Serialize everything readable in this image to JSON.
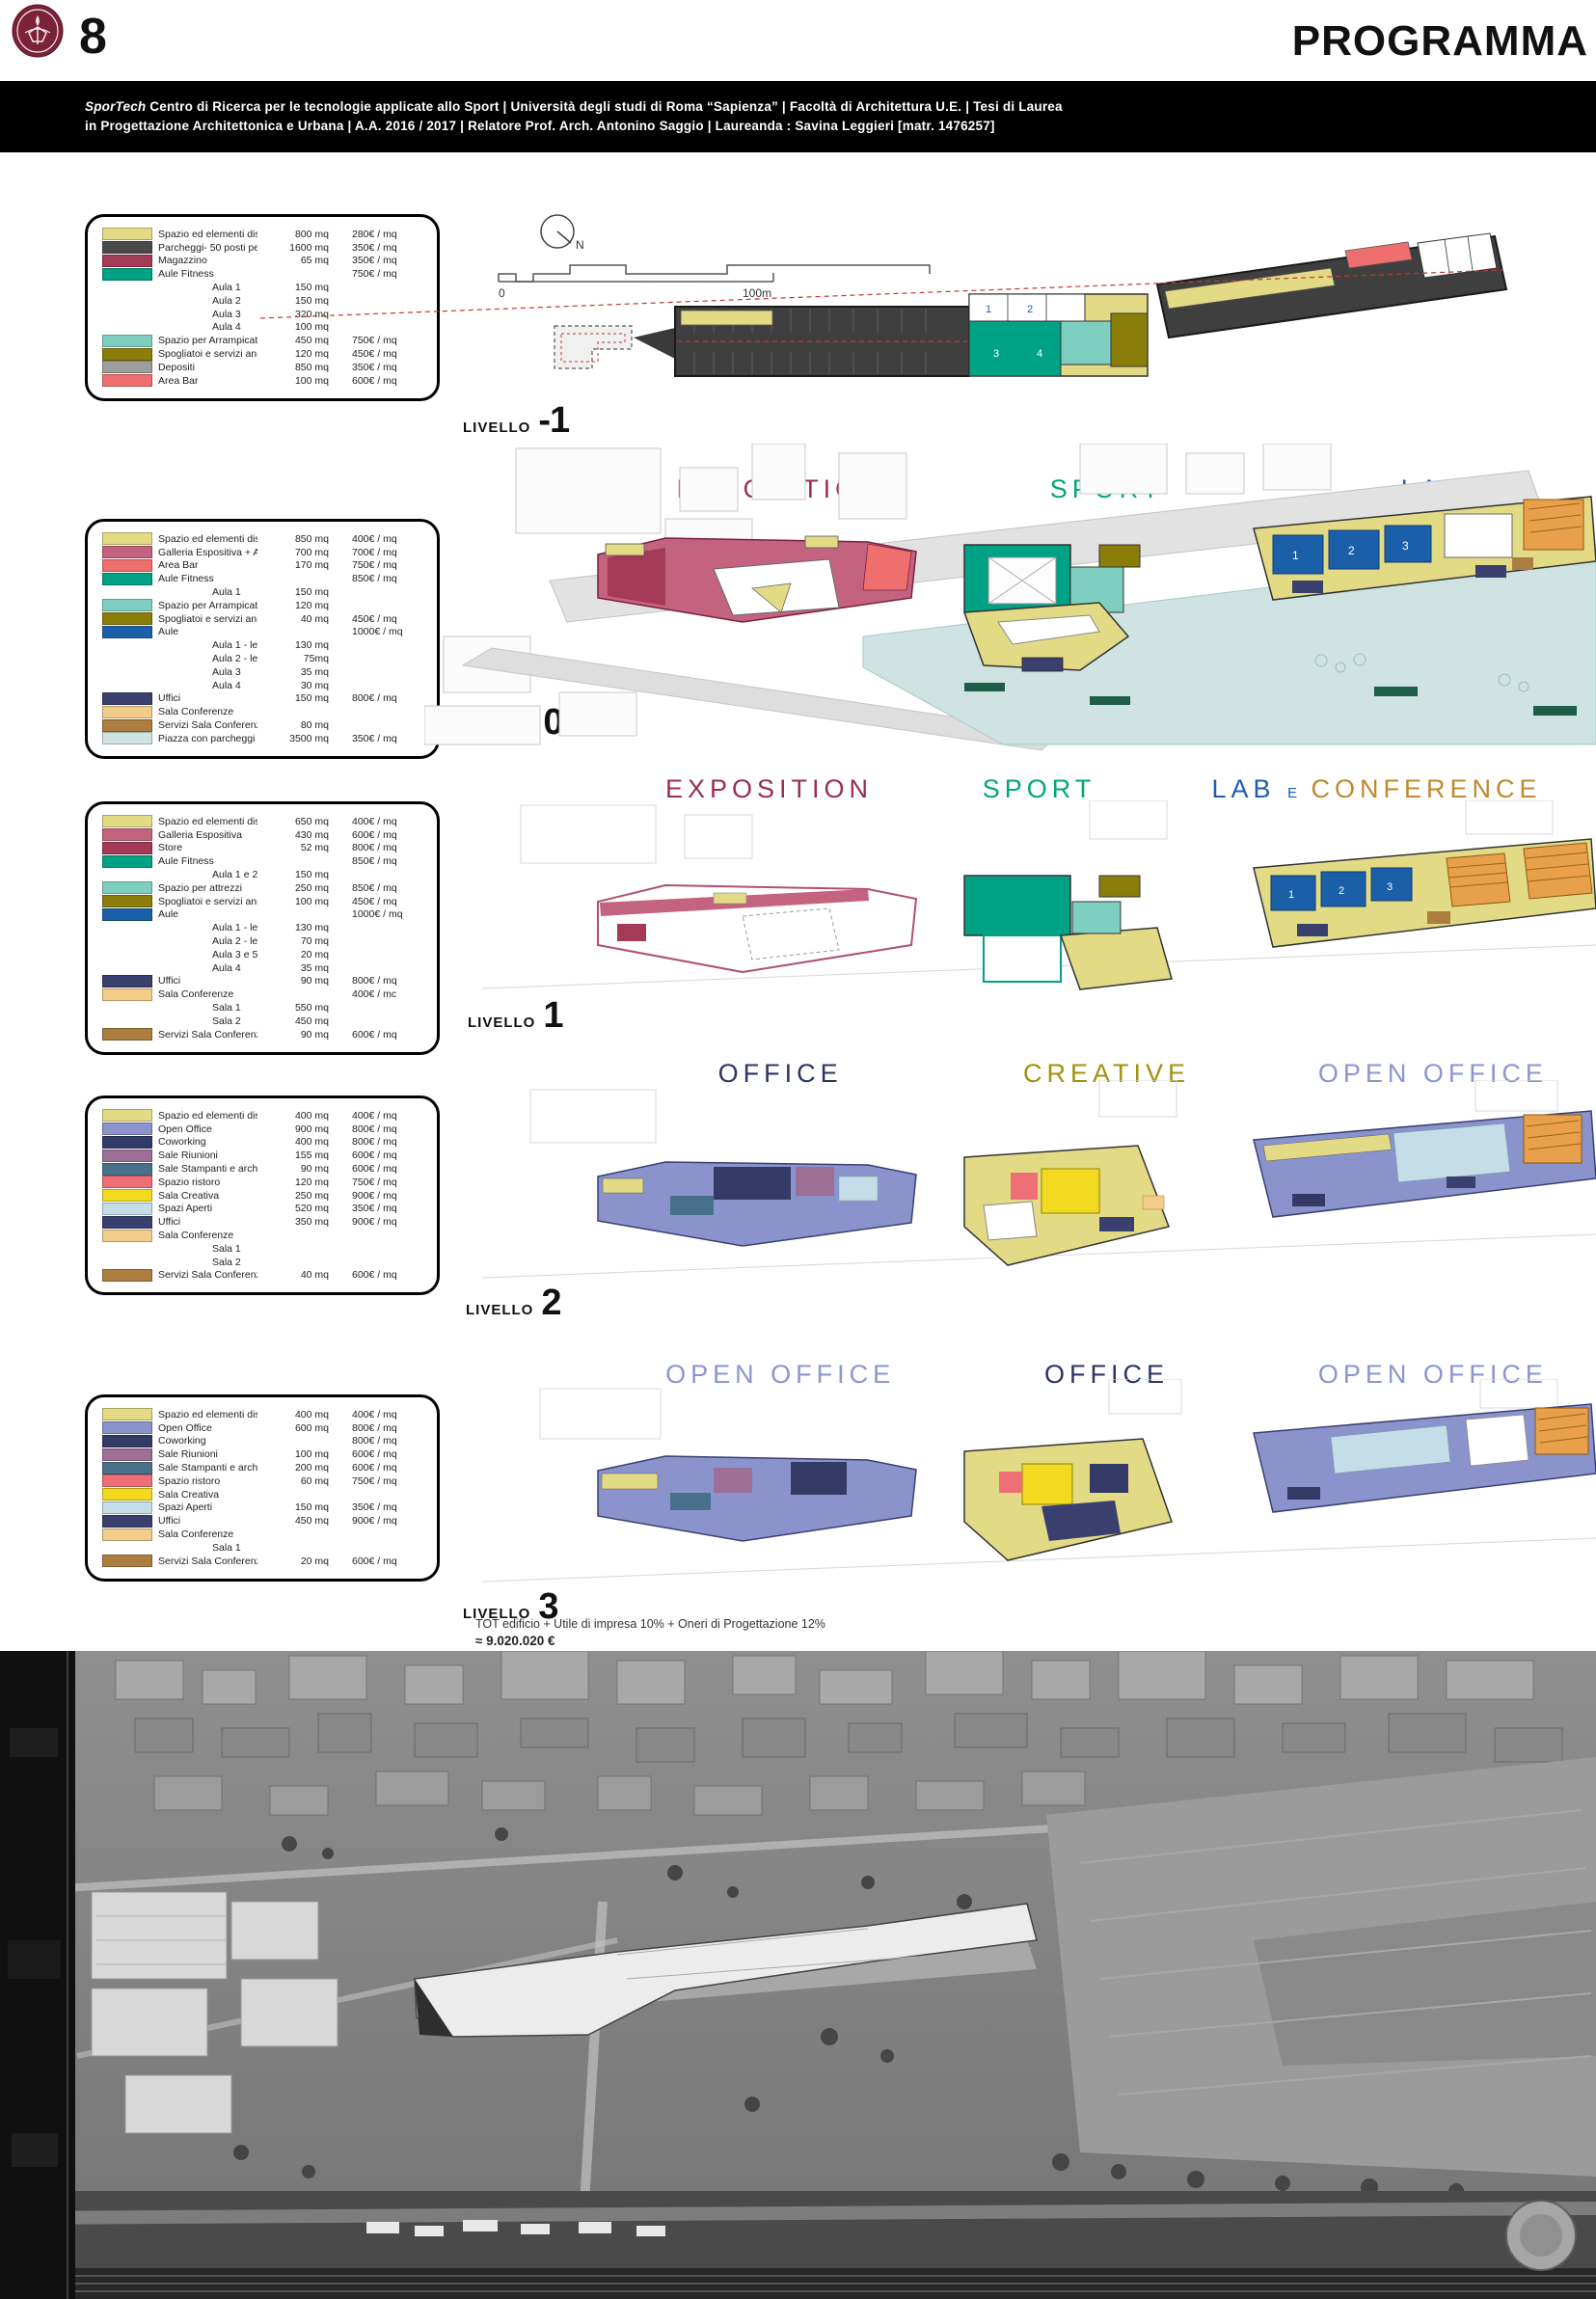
{
  "page": {
    "number": "8",
    "title": "PROGRAMMA",
    "subtitle_brand": "SporTech",
    "subtitle_line1": " Centro di Ricerca per le tecnologie applicate allo Sport | Università degli studi di Roma “Sapienza” | Facoltà di Architettura U.E. | Tesi di Laurea",
    "subtitle_line2": "in Progettazione Architettonica e Urbana | A.A. 2016 / 2017 | Relatore Prof. Arch. Antonino Saggio | Laureanda : Savina Leggieri [matr. 1476257]"
  },
  "map_tools": {
    "north_label": "N",
    "scale_start": "0",
    "scale_end": "100m"
  },
  "colors": {
    "sapienza_maroon": "#7b2138",
    "exposition": "#9b2d52",
    "sport": "#00a878",
    "lab": "#1d5fae",
    "conference": "#bf8a2e",
    "office": "#2b3560",
    "creative": "#a3920e",
    "open_office": "#8a96d0",
    "piazza": "#cfe3e3"
  },
  "totals": {
    "line1": "TOT edificio + Utile di impresa 10% + Oneri di Progettazione 12%",
    "line2": "≈ 9.020.020 €"
  },
  "levels": [
    {
      "label": "LIVELLO",
      "number": "-1",
      "headers": [],
      "plan_rooms": [
        "1",
        "2",
        "3",
        "4"
      ],
      "legend": [
        {
          "swatch": "#e3da85",
          "label": "Spazio ed elementi distributivi + servizi",
          "mq": "800 mq",
          "price": "280€ / mq"
        },
        {
          "swatch": "#4a4a4a",
          "label": "Parcheggi- 50 posti per piano",
          "mq": "1600 mq",
          "price": "350€ / mq"
        },
        {
          "swatch": "#a23a58",
          "label": "Magazzino",
          "mq": "65 mq",
          "price": "350€ / mq"
        },
        {
          "swatch": "#00a285",
          "label": "Aule Fitness",
          "mq": "",
          "price": "750€ / mq"
        },
        {
          "indent": true,
          "label": "Aula 1",
          "mq": "150 mq",
          "price": ""
        },
        {
          "indent": true,
          "label": "Aula 2",
          "mq": "150 mq",
          "price": ""
        },
        {
          "indent": true,
          "label": "Aula 3",
          "mq": "320 mq",
          "price": ""
        },
        {
          "indent": true,
          "label": "Aula 4",
          "mq": "100 mq",
          "price": ""
        },
        {
          "swatch": "#7fcfc0",
          "label": "Spazio per Arrampicata e distributivo",
          "mq": "450 mq",
          "price": "750€ / mq"
        },
        {
          "swatch": "#8a7d0a",
          "label": "Spogliatoi e servizi annessi",
          "mq": "120 mq",
          "price": "450€ / mq"
        },
        {
          "swatch": "#9e9e9e",
          "label": "Depositi",
          "mq": "850 mq",
          "price": "350€ / mq"
        },
        {
          "swatch": "#ef6f6f",
          "label": "Area Bar",
          "mq": "100 mq",
          "price": "600€ / mq"
        }
      ]
    },
    {
      "label": "LIVELLO",
      "number": "0",
      "headers": [
        {
          "text": "EXPOSITION",
          "color": "#9b2d52"
        },
        {
          "text": "SPORT",
          "color": "#00a878"
        },
        {
          "text": "LAB",
          "color": "#1d5fae"
        }
      ],
      "plan_rooms": [
        "1",
        "2",
        "3"
      ],
      "legend": [
        {
          "swatch": "#e3da85",
          "label": "Spazio ed elementi distributivi + servizi",
          "mq": "850 mq",
          "price": "400€ / mq"
        },
        {
          "swatch": "#c4637f",
          "label": "Galleria Espositiva + Area Biglietteria",
          "mq": "700 mq",
          "price": "700€ / mq"
        },
        {
          "swatch": "#ef6f6f",
          "label": "Area Bar",
          "mq": "170 mq",
          "price": "750€ / mq"
        },
        {
          "swatch": "#00a285",
          "label": "Aule Fitness",
          "mq": "",
          "price": "850€ / mq"
        },
        {
          "indent": true,
          "label": "Aula 1",
          "mq": "150 mq",
          "price": ""
        },
        {
          "swatch": "#7fcfc0",
          "label": "Spazio per Arrampicata",
          "mq": "120 mq",
          "price": ""
        },
        {
          "swatch": "#8a7d0a",
          "label": "Spogliatoi e servizi annessi",
          "mq": "40 mq",
          "price": "450€ / mq"
        },
        {
          "swatch": "#1a5fa8",
          "label": "Aule",
          "mq": "",
          "price": "1000€ / mq"
        },
        {
          "indent": true,
          "label": "Aula 1 - lezioni frontali",
          "mq": "130 mq",
          "price": ""
        },
        {
          "indent": true,
          "label": "Aula 2 - lezioni frontali",
          "mq": "75mq",
          "price": ""
        },
        {
          "indent": true,
          "label": "Aula 3",
          "mq": "35 mq",
          "price": ""
        },
        {
          "indent": true,
          "label": "Aula 4",
          "mq": "30 mq",
          "price": ""
        },
        {
          "swatch": "#39406e",
          "label": "Uffici",
          "mq": "150 mq",
          "price": "800€ / mq"
        },
        {
          "swatch": "#f2cd8a",
          "label": "Sala Conferenze",
          "mq": "",
          "price": ""
        },
        {
          "swatch": "#ab7d3f",
          "label": "Servizi Sala Conferenze",
          "mq": "80 mq",
          "price": ""
        },
        {
          "swatch": "#cfe3e3",
          "label": "Piazza con parcheggi bici",
          "mq": "3500 mq",
          "price": "350€ / mq"
        }
      ]
    },
    {
      "label": "LIVELLO",
      "number": "1",
      "headers": [
        {
          "text": "EXPOSITION",
          "color": "#9b2d52"
        },
        {
          "text": "SPORT",
          "color": "#00a878"
        },
        {
          "text": "LAB",
          "color": "#1d5fae"
        },
        {
          "text": "E",
          "color": "#1d5fae",
          "small": true
        },
        {
          "text": "CONFERENCE",
          "color": "#bf8a2e"
        }
      ],
      "plan_rooms": [
        "1",
        "2",
        "3"
      ],
      "legend": [
        {
          "swatch": "#e3da85",
          "label": "Spazio ed elementi distributivi + servizi",
          "mq": "650 mq",
          "price": "400€ / mq"
        },
        {
          "swatch": "#c4637f",
          "label": "Galleria Espositiva",
          "mq": "430 mq",
          "price": "600€ / mq"
        },
        {
          "swatch": "#a23a58",
          "label": "Store",
          "mq": "52 mq",
          "price": "800€ / mq"
        },
        {
          "swatch": "#00a285",
          "label": "Aule Fitness",
          "mq": "",
          "price": "850€ / mq"
        },
        {
          "indent": true,
          "label": "Aula 1 e 2",
          "mq": "150 mq",
          "price": ""
        },
        {
          "swatch": "#7fcfc0",
          "label": "Spazio per attrezzi",
          "mq": "250 mq",
          "price": "850€ / mq"
        },
        {
          "swatch": "#8a7d0a",
          "label": "Spogliatoi e servizi annessi",
          "mq": "100 mq",
          "price": "450€ / mq"
        },
        {
          "swatch": "#1a5fa8",
          "label": "Aule",
          "mq": "",
          "price": "1000€ / mq"
        },
        {
          "indent": true,
          "label": "Aula 1 - lezioni frontali",
          "mq": "130 mq",
          "price": ""
        },
        {
          "indent": true,
          "label": "Aula 2 - lezioni frontali",
          "mq": "70 mq",
          "price": ""
        },
        {
          "indent": true,
          "label": "Aula 3 e 5",
          "mq": "20 mq",
          "price": ""
        },
        {
          "indent": true,
          "label": "Aula 4",
          "mq": "35 mq",
          "price": ""
        },
        {
          "swatch": "#39406e",
          "label": "Uffici",
          "mq": "90 mq",
          "price": "800€ / mq"
        },
        {
          "swatch": "#f2cd8a",
          "label": "Sala Conferenze",
          "mq": "",
          "price": "400€ / mc"
        },
        {
          "indent": true,
          "label": "Sala 1",
          "mq": "550 mq",
          "price": ""
        },
        {
          "indent": true,
          "label": "Sala 2",
          "mq": "450 mq",
          "price": ""
        },
        {
          "swatch": "#ab7d3f",
          "label": "Servizi Sala Conferenze",
          "mq": "90 mq",
          "price": "600€ / mq"
        }
      ]
    },
    {
      "label": "LIVELLO",
      "number": "2",
      "headers": [
        {
          "text": "OFFICE",
          "color": "#2b3560"
        },
        {
          "text": "CREATIVE",
          "color": "#a3920e"
        },
        {
          "text": "OPEN OFFICE",
          "color": "#8a96d0"
        }
      ],
      "plan_rooms": [],
      "legend": [
        {
          "swatch": "#e3da85",
          "label": "Spazio ed elementi distributivi + servizi",
          "mq": "400 mq",
          "price": "400€ / mq"
        },
        {
          "swatch": "#8a93cc",
          "label": "Open Office",
          "mq": "900 mq",
          "price": "800€ / mq"
        },
        {
          "swatch": "#333a66",
          "label": "Coworking",
          "mq": "400 mq",
          "price": "800€ / mq"
        },
        {
          "swatch": "#9b6f96",
          "label": "Sale Riunioni",
          "mq": "155 mq",
          "price": "600€ / mq"
        },
        {
          "swatch": "#49708a",
          "label": "Sale Stampanti e archivi",
          "mq": "90 mq",
          "price": "600€ / mq"
        },
        {
          "swatch": "#ee6f76",
          "label": "Spazio ristoro",
          "mq": "120 mq",
          "price": "750€ / mq"
        },
        {
          "swatch": "#f2da20",
          "label": "Sala Creativa",
          "mq": "250 mq",
          "price": "900€ / mq"
        },
        {
          "swatch": "#c5dde8",
          "label": "Spazi Aperti",
          "mq": "520 mq",
          "price": "350€ / mq"
        },
        {
          "swatch": "#39406e",
          "label": "Uffici",
          "mq": "350 mq",
          "price": "900€ / mq"
        },
        {
          "swatch": "#f2cd8a",
          "label": "Sala Conferenze",
          "mq": "",
          "price": ""
        },
        {
          "indent": true,
          "label": "Sala 1",
          "mq": "",
          "price": ""
        },
        {
          "indent": true,
          "label": "Sala 2",
          "mq": "",
          "price": ""
        },
        {
          "swatch": "#ab7d3f",
          "label": "Servizi Sala Conferenze",
          "mq": "40 mq",
          "price": "600€ / mq"
        }
      ]
    },
    {
      "label": "LIVELLO",
      "number": "3",
      "headers": [
        {
          "text": "OPEN OFFICE",
          "color": "#8a96d0"
        },
        {
          "text": "OFFICE",
          "color": "#2b3560"
        },
        {
          "text": "OPEN OFFICE",
          "color": "#8a96d0"
        }
      ],
      "plan_rooms": [],
      "legend": [
        {
          "swatch": "#e3da85",
          "label": "Spazio ed elementi distributivi + servizi",
          "mq": "400 mq",
          "price": "400€ / mq"
        },
        {
          "swatch": "#8a93cc",
          "label": "Open Office",
          "mq": "600 mq",
          "price": "800€ / mq"
        },
        {
          "swatch": "#333a66",
          "label": "Coworking",
          "mq": "",
          "price": "800€ / mq"
        },
        {
          "swatch": "#9b6f96",
          "label": "Sale Riunioni",
          "mq": "100 mq",
          "price": "600€ / mq"
        },
        {
          "swatch": "#49708a",
          "label": "Sale Stampanti e archivi",
          "mq": "200 mq",
          "price": "600€ / mq"
        },
        {
          "swatch": "#ee6f76",
          "label": "Spazio ristoro",
          "mq": "60 mq",
          "price": "750€ / mq"
        },
        {
          "swatch": "#f2da20",
          "label": "Sala Creativa",
          "mq": "",
          "price": ""
        },
        {
          "swatch": "#c5dde8",
          "label": "Spazi Aperti",
          "mq": "150 mq",
          "price": "350€ / mq"
        },
        {
          "swatch": "#39406e",
          "label": "Uffici",
          "mq": "450 mq",
          "price": "900€ / mq"
        },
        {
          "swatch": "#f2cd8a",
          "label": "Sala Conferenze",
          "mq": "",
          "price": ""
        },
        {
          "indent": true,
          "label": "Sala 1",
          "mq": "",
          "price": ""
        },
        {
          "swatch": "#ab7d3f",
          "label": "Servizi Sala Conferenze",
          "mq": "20 mq",
          "price": "600€ / mq"
        }
      ]
    }
  ]
}
